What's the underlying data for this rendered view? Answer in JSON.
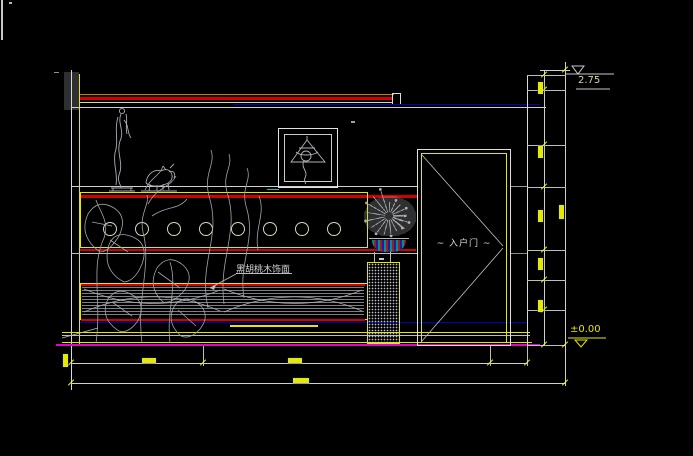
{
  "labels": {
    "material": "黑胡桃木饰面",
    "door": "~ 入户门 ~"
  },
  "elevation_markers": {
    "top": "2.75",
    "bottom": "±0.00"
  },
  "decor": {
    "wall_circle_count": 8
  },
  "colors": {
    "background": "#000000",
    "line_white": "#d9d9d9",
    "cad_yellow": "#e6e600",
    "dim_yellow": "#ffff00",
    "red": "#d40000",
    "orange": "#d07800",
    "navy": "#0000b8",
    "magenta": "#e000e0",
    "cyan": "#00c8c8",
    "art_grey": "#a8adb3"
  }
}
